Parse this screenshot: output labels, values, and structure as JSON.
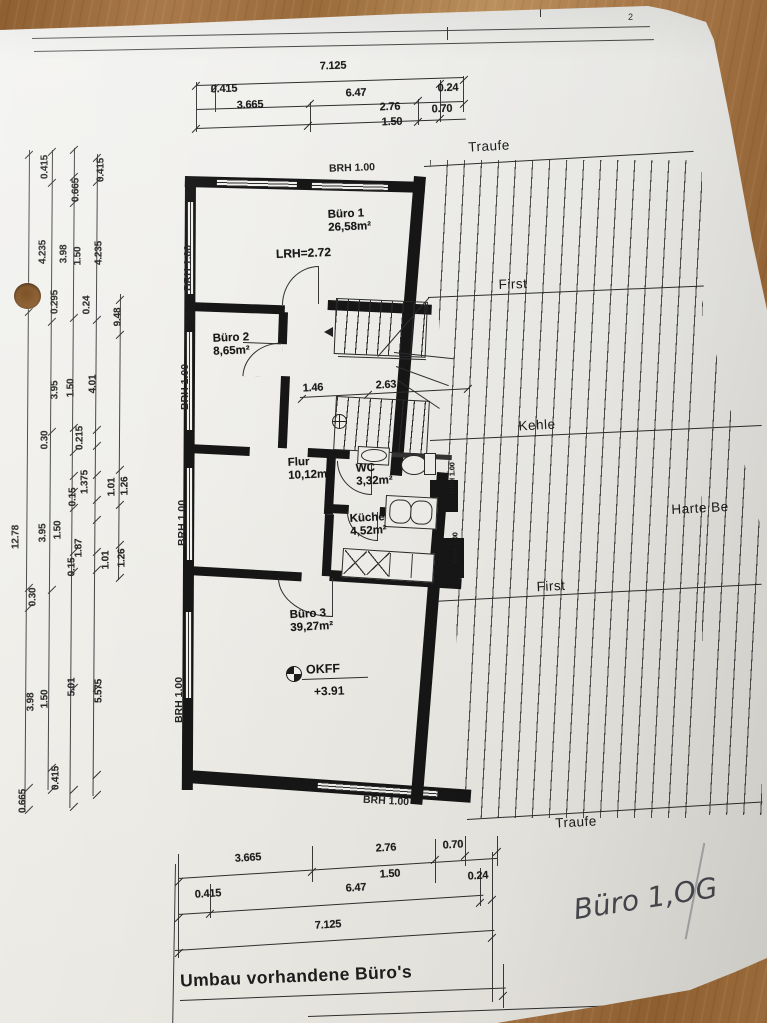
{
  "sheet": {
    "title": "Umbau vorhandene Büro's",
    "handwriting": "Büro 1,OG",
    "fold_number": "2"
  },
  "rooms": {
    "buero1": {
      "name": "Büro 1",
      "area": "26,58m²",
      "note": "LRH=2.72"
    },
    "buero2": {
      "name": "Büro 2",
      "area": "8,65m²"
    },
    "flur": {
      "name": "Flur",
      "area": "10,12m²"
    },
    "wc": {
      "name": "WC",
      "area": "3,32m²"
    },
    "kueche": {
      "name": "Küche",
      "area": "4,52m²"
    },
    "buero3": {
      "name": "Büro 3",
      "area": "39,27m²"
    }
  },
  "level_marker": {
    "label": "OKFF",
    "value": "+3.91"
  },
  "roof_labels": [
    {
      "t": "Traufe",
      "x": 489,
      "y": 146,
      "rot": -3
    },
    {
      "t": "First",
      "x": 513,
      "y": 284,
      "rot": -2
    },
    {
      "t": "Kehle",
      "x": 537,
      "y": 425,
      "rot": -3
    },
    {
      "t": "Harte Be",
      "x": 700,
      "y": 508,
      "rot": -3
    },
    {
      "t": "First",
      "x": 551,
      "y": 586,
      "rot": -3
    },
    {
      "t": "Traufe",
      "x": 576,
      "y": 822,
      "rot": -3
    }
  ],
  "brh_labels": [
    {
      "t": "BRH  1.00",
      "x": 352,
      "y": 168,
      "rot": -2
    },
    {
      "t": "BRH  1.00",
      "x": 188,
      "y": 268,
      "rot": -90
    },
    {
      "t": "BRH  1.00",
      "x": 185,
      "y": 387,
      "rot": -90
    },
    {
      "t": "BRH  1.00",
      "x": 182,
      "y": 523,
      "rot": -90
    },
    {
      "t": "BRH  1.00",
      "x": 179,
      "y": 700,
      "rot": -90
    },
    {
      "t": "BRH  1.00",
      "x": 386,
      "y": 801,
      "rot": 3
    }
  ],
  "dims": {
    "top": [
      {
        "t": "7.125",
        "x": 333,
        "y": 66,
        "rot": -2
      },
      {
        "t": "0.415",
        "x": 224,
        "y": 89,
        "rot": -2
      },
      {
        "t": "6.47",
        "x": 356,
        "y": 93,
        "rot": -2
      },
      {
        "t": "0.24",
        "x": 448,
        "y": 88,
        "rot": -2
      },
      {
        "t": "3.665",
        "x": 250,
        "y": 105,
        "rot": -2
      },
      {
        "t": "2.76",
        "x": 390,
        "y": 107,
        "rot": -2
      },
      {
        "t": "0.70",
        "x": 442,
        "y": 109,
        "rot": -2
      },
      {
        "t": "1.50",
        "x": 392,
        "y": 122,
        "rot": -2
      }
    ],
    "bottom": [
      {
        "t": "3.665",
        "x": 248,
        "y": 858,
        "rot": -3.5
      },
      {
        "t": "2.76",
        "x": 386,
        "y": 848,
        "rot": -3.5
      },
      {
        "t": "0.70",
        "x": 453,
        "y": 845,
        "rot": -3.5
      },
      {
        "t": "1.50",
        "x": 390,
        "y": 874,
        "rot": -3.5
      },
      {
        "t": "0.24",
        "x": 478,
        "y": 876,
        "rot": -3.5
      },
      {
        "t": "0.415",
        "x": 208,
        "y": 894,
        "rot": -3.5
      },
      {
        "t": "6.47",
        "x": 356,
        "y": 888,
        "rot": -3.5
      },
      {
        "t": "7.125",
        "x": 328,
        "y": 925,
        "rot": -3.5
      }
    ],
    "inner": [
      {
        "t": "1.46",
        "x": 313,
        "y": 388,
        "rot": -3
      },
      {
        "t": "2.63",
        "x": 386,
        "y": 385,
        "rot": -3
      }
    ],
    "left": [
      {
        "t": "0.415",
        "x": 45,
        "y": 167,
        "rot": -90
      },
      {
        "t": "0.665",
        "x": 76,
        "y": 190,
        "rot": -90
      },
      {
        "t": "0.415",
        "x": 101,
        "y": 170,
        "rot": -90
      },
      {
        "t": "4.235",
        "x": 43,
        "y": 252,
        "rot": -90
      },
      {
        "t": "3.98",
        "x": 64,
        "y": 254,
        "rot": -90
      },
      {
        "t": "1.50",
        "x": 78,
        "y": 256,
        "rot": -90
      },
      {
        "t": "4.235",
        "x": 99,
        "y": 253,
        "rot": -90
      },
      {
        "t": "0.2",
        "x": 29,
        "y": 300,
        "rot": -90
      },
      {
        "t": "0.295",
        "x": 55,
        "y": 302,
        "rot": -90
      },
      {
        "t": "0.24",
        "x": 87,
        "y": 305,
        "rot": -90
      },
      {
        "t": "9.48",
        "x": 118,
        "y": 317,
        "rot": -90
      },
      {
        "t": "3.95",
        "x": 55,
        "y": 390,
        "rot": -90
      },
      {
        "t": "1.50",
        "x": 71,
        "y": 388,
        "rot": -90
      },
      {
        "t": "4.01",
        "x": 93,
        "y": 384,
        "rot": -90
      },
      {
        "t": "0.30",
        "x": 45,
        "y": 440,
        "rot": -90
      },
      {
        "t": "0.215",
        "x": 80,
        "y": 438,
        "rot": -90
      },
      {
        "t": "1.375",
        "x": 85,
        "y": 482,
        "rot": -90
      },
      {
        "t": "0.15",
        "x": 73,
        "y": 497,
        "rot": -90
      },
      {
        "t": "1.01",
        "x": 112,
        "y": 487,
        "rot": -90
      },
      {
        "t": "1.26",
        "x": 125,
        "y": 486,
        "rot": -90
      },
      {
        "t": "12.78",
        "x": 16,
        "y": 537,
        "rot": -90
      },
      {
        "t": "3.95",
        "x": 43,
        "y": 533,
        "rot": -90
      },
      {
        "t": "1.50",
        "x": 58,
        "y": 530,
        "rot": -90
      },
      {
        "t": "1.87",
        "x": 79,
        "y": 548,
        "rot": -90
      },
      {
        "t": "0.15",
        "x": 72,
        "y": 567,
        "rot": -90
      },
      {
        "t": "1.01",
        "x": 106,
        "y": 560,
        "rot": -90
      },
      {
        "t": "1.26",
        "x": 122,
        "y": 558,
        "rot": -90
      },
      {
        "t": "0.30",
        "x": 33,
        "y": 597,
        "rot": -90
      },
      {
        "t": "3.98",
        "x": 31,
        "y": 702,
        "rot": -90
      },
      {
        "t": "1.50",
        "x": 45,
        "y": 699,
        "rot": -90
      },
      {
        "t": "5.01",
        "x": 72,
        "y": 687,
        "rot": -90
      },
      {
        "t": "5.575",
        "x": 99,
        "y": 691,
        "rot": -90
      },
      {
        "t": "0.415",
        "x": 56,
        "y": 778,
        "rot": -90
      },
      {
        "t": "0.665",
        "x": 23,
        "y": 801,
        "rot": -90
      }
    ],
    "right_wall": [
      {
        "t": "BRH 1.00",
        "x": 452,
        "y": 478,
        "rot": -90
      },
      {
        "t": "BRH 1.00",
        "x": 455,
        "y": 548,
        "rot": -90
      }
    ]
  },
  "ticks": [
    {
      "x": 29,
      "y": 155
    },
    {
      "x": 29,
      "y": 292
    },
    {
      "x": 29,
      "y": 312
    },
    {
      "x": 29,
      "y": 588
    },
    {
      "x": 29,
      "y": 608
    },
    {
      "x": 29,
      "y": 788
    },
    {
      "x": 29,
      "y": 810
    },
    {
      "x": 52,
      "y": 152
    },
    {
      "x": 52,
      "y": 183
    },
    {
      "x": 52,
      "y": 322
    },
    {
      "x": 52,
      "y": 432
    },
    {
      "x": 52,
      "y": 590
    },
    {
      "x": 52,
      "y": 768
    },
    {
      "x": 52,
      "y": 790
    },
    {
      "x": 74,
      "y": 150
    },
    {
      "x": 74,
      "y": 177
    },
    {
      "x": 74,
      "y": 203
    },
    {
      "x": 74,
      "y": 318
    },
    {
      "x": 74,
      "y": 428
    },
    {
      "x": 74,
      "y": 452
    },
    {
      "x": 74,
      "y": 476
    },
    {
      "x": 74,
      "y": 492
    },
    {
      "x": 74,
      "y": 508
    },
    {
      "x": 74,
      "y": 552
    },
    {
      "x": 74,
      "y": 572
    },
    {
      "x": 74,
      "y": 688
    },
    {
      "x": 74,
      "y": 790
    },
    {
      "x": 74,
      "y": 807
    },
    {
      "x": 97,
      "y": 158
    },
    {
      "x": 97,
      "y": 182
    },
    {
      "x": 97,
      "y": 320
    },
    {
      "x": 97,
      "y": 430
    },
    {
      "x": 97,
      "y": 446
    },
    {
      "x": 97,
      "y": 475
    },
    {
      "x": 97,
      "y": 500
    },
    {
      "x": 97,
      "y": 520
    },
    {
      "x": 97,
      "y": 552
    },
    {
      "x": 97,
      "y": 570
    },
    {
      "x": 97,
      "y": 688
    },
    {
      "x": 97,
      "y": 775
    },
    {
      "x": 97,
      "y": 795
    },
    {
      "x": 120,
      "y": 300
    },
    {
      "x": 120,
      "y": 335
    },
    {
      "x": 120,
      "y": 470
    },
    {
      "x": 120,
      "y": 505
    },
    {
      "x": 120,
      "y": 545
    },
    {
      "x": 120,
      "y": 578
    },
    {
      "x": 196,
      "y": 86
    },
    {
      "x": 464,
      "y": 80
    },
    {
      "x": 215,
      "y": 88
    },
    {
      "x": 440,
      "y": 84
    },
    {
      "x": 310,
      "y": 104
    },
    {
      "x": 418,
      "y": 101
    },
    {
      "x": 196,
      "y": 129
    },
    {
      "x": 308,
      "y": 126
    },
    {
      "x": 418,
      "y": 122
    },
    {
      "x": 440,
      "y": 119
    },
    {
      "x": 464,
      "y": 104
    },
    {
      "x": 179,
      "y": 882
    },
    {
      "x": 312,
      "y": 872
    },
    {
      "x": 435,
      "y": 860
    },
    {
      "x": 465,
      "y": 856
    },
    {
      "x": 497,
      "y": 852
    },
    {
      "x": 179,
      "y": 918
    },
    {
      "x": 210,
      "y": 914
    },
    {
      "x": 480,
      "y": 903
    },
    {
      "x": 492,
      "y": 900
    },
    {
      "x": 179,
      "y": 953
    },
    {
      "x": 492,
      "y": 938
    },
    {
      "x": 302,
      "y": 399
    },
    {
      "x": 368,
      "y": 395
    },
    {
      "x": 468,
      "y": 389
    },
    {
      "x": 503,
      "y": 996
    }
  ]
}
